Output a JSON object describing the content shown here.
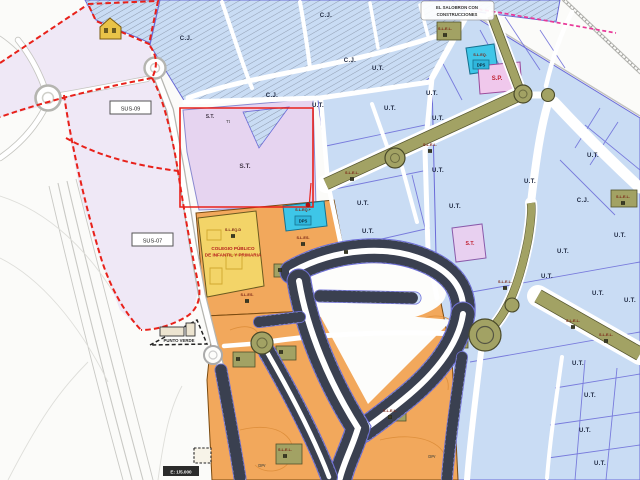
{
  "map": {
    "colors": {
      "residential_blue": "#c9dcf4",
      "parcel_border": "#6b6bd8",
      "sector_lavender": "#efe8f6",
      "st_lavender": "#e6d4f0",
      "orange_zone": "#f2a85c",
      "school_yellow": "#f3d468",
      "equipment_cyan": "#3ec6e8",
      "green_olive": "#a2a264",
      "pink_parcel": "#f0c8ec",
      "boundary_red": "#e8211a",
      "limit_magenta": "#e83898"
    },
    "sector_boxes": {
      "sus09": "SUS-09",
      "sus07": "SUS-07"
    },
    "development_note": {
      "line1": "EL SALOBRON CON",
      "line2": "CONSTRUCCIONES"
    },
    "school": {
      "line1": "COLEGIO PÚBLICO",
      "line2": "DE INFANTIL Y PRIMARIA"
    },
    "green_point_label": "PUNTO VERDE",
    "scale_label": "E: 1/5.000",
    "equipment_badge": "DPS",
    "region_labels": [
      {
        "text": "C.J.",
        "x": 326,
        "y": 17,
        "kind": "ut"
      },
      {
        "text": "C.J.",
        "x": 350,
        "y": 62,
        "kind": "ut"
      },
      {
        "text": "C.J.",
        "x": 272,
        "y": 97,
        "kind": "ut"
      },
      {
        "text": "C.J.",
        "x": 186,
        "y": 40,
        "kind": "ut"
      },
      {
        "text": "U.T.",
        "x": 378,
        "y": 70,
        "kind": "ut"
      },
      {
        "text": "U.T.",
        "x": 318,
        "y": 107,
        "kind": "ut"
      },
      {
        "text": "U.T.",
        "x": 390,
        "y": 110,
        "kind": "ut"
      },
      {
        "text": "U.T.",
        "x": 432,
        "y": 95,
        "kind": "ut"
      },
      {
        "text": "U.T.",
        "x": 438,
        "y": 120,
        "kind": "ut"
      },
      {
        "text": "U.T.",
        "x": 593,
        "y": 157,
        "kind": "ut"
      },
      {
        "text": "U.T.",
        "x": 438,
        "y": 172,
        "kind": "ut"
      },
      {
        "text": "U.T.",
        "x": 455,
        "y": 208,
        "kind": "ut"
      },
      {
        "text": "U.T.",
        "x": 530,
        "y": 183,
        "kind": "ut"
      },
      {
        "text": "C.J.",
        "x": 583,
        "y": 202,
        "kind": "ut"
      },
      {
        "text": "U.T.",
        "x": 620,
        "y": 237,
        "kind": "ut"
      },
      {
        "text": "U.T.",
        "x": 563,
        "y": 253,
        "kind": "ut"
      },
      {
        "text": "U.T.",
        "x": 363,
        "y": 205,
        "kind": "ut"
      },
      {
        "text": "U.T.",
        "x": 368,
        "y": 233,
        "kind": "ut"
      },
      {
        "text": "U.T.",
        "x": 547,
        "y": 278,
        "kind": "ut"
      },
      {
        "text": "U.T.",
        "x": 598,
        "y": 295,
        "kind": "ut"
      },
      {
        "text": "U.T.",
        "x": 630,
        "y": 302,
        "kind": "ut"
      },
      {
        "text": "U.T.",
        "x": 578,
        "y": 365,
        "kind": "ut"
      },
      {
        "text": "U.T.",
        "x": 590,
        "y": 397,
        "kind": "ut"
      },
      {
        "text": "U.T.",
        "x": 585,
        "y": 432,
        "kind": "ut"
      },
      {
        "text": "U.T.",
        "x": 600,
        "y": 465,
        "kind": "ut"
      },
      {
        "text": "S.T.",
        "x": 210,
        "y": 118,
        "kind": "stsm"
      },
      {
        "text": "Tt",
        "x": 228,
        "y": 123,
        "kind": "tt"
      },
      {
        "text": "S.T.",
        "x": 245,
        "y": 168,
        "kind": "st"
      },
      {
        "text": "S.T.",
        "x": 470,
        "y": 245,
        "kind": "stred"
      },
      {
        "text": "S.P.",
        "x": 497,
        "y": 80,
        "kind": "red"
      },
      {
        "text": "S.L.E.L.",
        "x": 352,
        "y": 174,
        "kind": "sl"
      },
      {
        "text": "S.L.E.L.",
        "x": 430,
        "y": 146,
        "kind": "sl"
      },
      {
        "text": "S.L.E.L.",
        "x": 445,
        "y": 30,
        "kind": "sl"
      },
      {
        "text": "S.L.E.L.",
        "x": 505,
        "y": 283,
        "kind": "sl"
      },
      {
        "text": "S.L.E.L.",
        "x": 573,
        "y": 322,
        "kind": "sl"
      },
      {
        "text": "S.L.E.L.",
        "x": 606,
        "y": 336,
        "kind": "sl"
      },
      {
        "text": "S.L.E.L.",
        "x": 623,
        "y": 198,
        "kind": "sl"
      },
      {
        "text": "S.L.E.L.",
        "x": 390,
        "y": 412,
        "kind": "sl"
      },
      {
        "text": "S.L.E.L.",
        "x": 285,
        "y": 451,
        "kind": "sl"
      },
      {
        "text": "S.L.ES.",
        "x": 303,
        "y": 239,
        "kind": "sl"
      },
      {
        "text": "S.L.ES.",
        "x": 247,
        "y": 296,
        "kind": "sl"
      },
      {
        "text": "S.L.EQ.+",
        "x": 303,
        "y": 211,
        "kind": "sl"
      },
      {
        "text": "S.L.EQ.",
        "x": 480,
        "y": 56,
        "kind": "sl"
      },
      {
        "text": "S.L.EQ.D",
        "x": 233,
        "y": 231,
        "kind": "sl"
      },
      {
        "text": "DPr",
        "x": 262,
        "y": 467,
        "kind": "dpr"
      },
      {
        "text": "DPr",
        "x": 432,
        "y": 458,
        "kind": "dpr"
      }
    ],
    "facility_icons": [
      {
        "x": 352,
        "y": 179
      },
      {
        "x": 430,
        "y": 151
      },
      {
        "x": 445,
        "y": 35
      },
      {
        "x": 505,
        "y": 288
      },
      {
        "x": 573,
        "y": 327
      },
      {
        "x": 606,
        "y": 341
      },
      {
        "x": 623,
        "y": 203
      },
      {
        "x": 390,
        "y": 417
      },
      {
        "x": 285,
        "y": 456
      },
      {
        "x": 303,
        "y": 244
      },
      {
        "x": 247,
        "y": 301
      },
      {
        "x": 233,
        "y": 236
      },
      {
        "x": 238,
        "y": 359
      },
      {
        "x": 281,
        "y": 352
      },
      {
        "x": 280,
        "y": 270
      },
      {
        "x": 346,
        "y": 252
      }
    ]
  }
}
